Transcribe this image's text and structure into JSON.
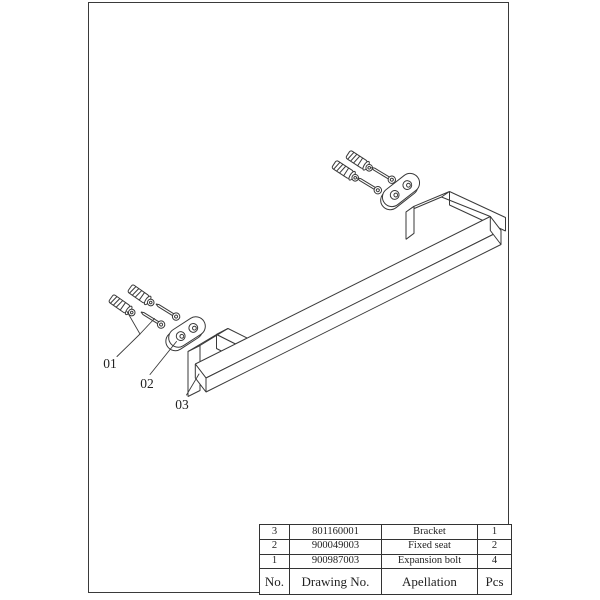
{
  "colors": {
    "line": "#3a3a3a",
    "text": "#222222",
    "background": "#ffffff"
  },
  "drawing": {
    "type": "exploded-assembly-technical-drawing",
    "subject": "towel bar bracket with fixed seats and expansion bolts",
    "callouts": [
      {
        "id": "01",
        "points_to": "expansion-bolt"
      },
      {
        "id": "02",
        "points_to": "fixed-seat"
      },
      {
        "id": "03",
        "points_to": "bracket"
      }
    ]
  },
  "parts_table": {
    "header": {
      "no": "No.",
      "drawing_no": "Drawing No.",
      "apellation": "Apellation",
      "pcs": "Pcs"
    },
    "rows": [
      {
        "no": "3",
        "drawing_no": "801160001",
        "apellation": "Bracket",
        "pcs": "1"
      },
      {
        "no": "2",
        "drawing_no": "900049003",
        "apellation": "Fixed seat",
        "pcs": "2"
      },
      {
        "no": "1",
        "drawing_no": "900987003",
        "apellation": "Expansion bolt",
        "pcs": "4"
      }
    ]
  }
}
